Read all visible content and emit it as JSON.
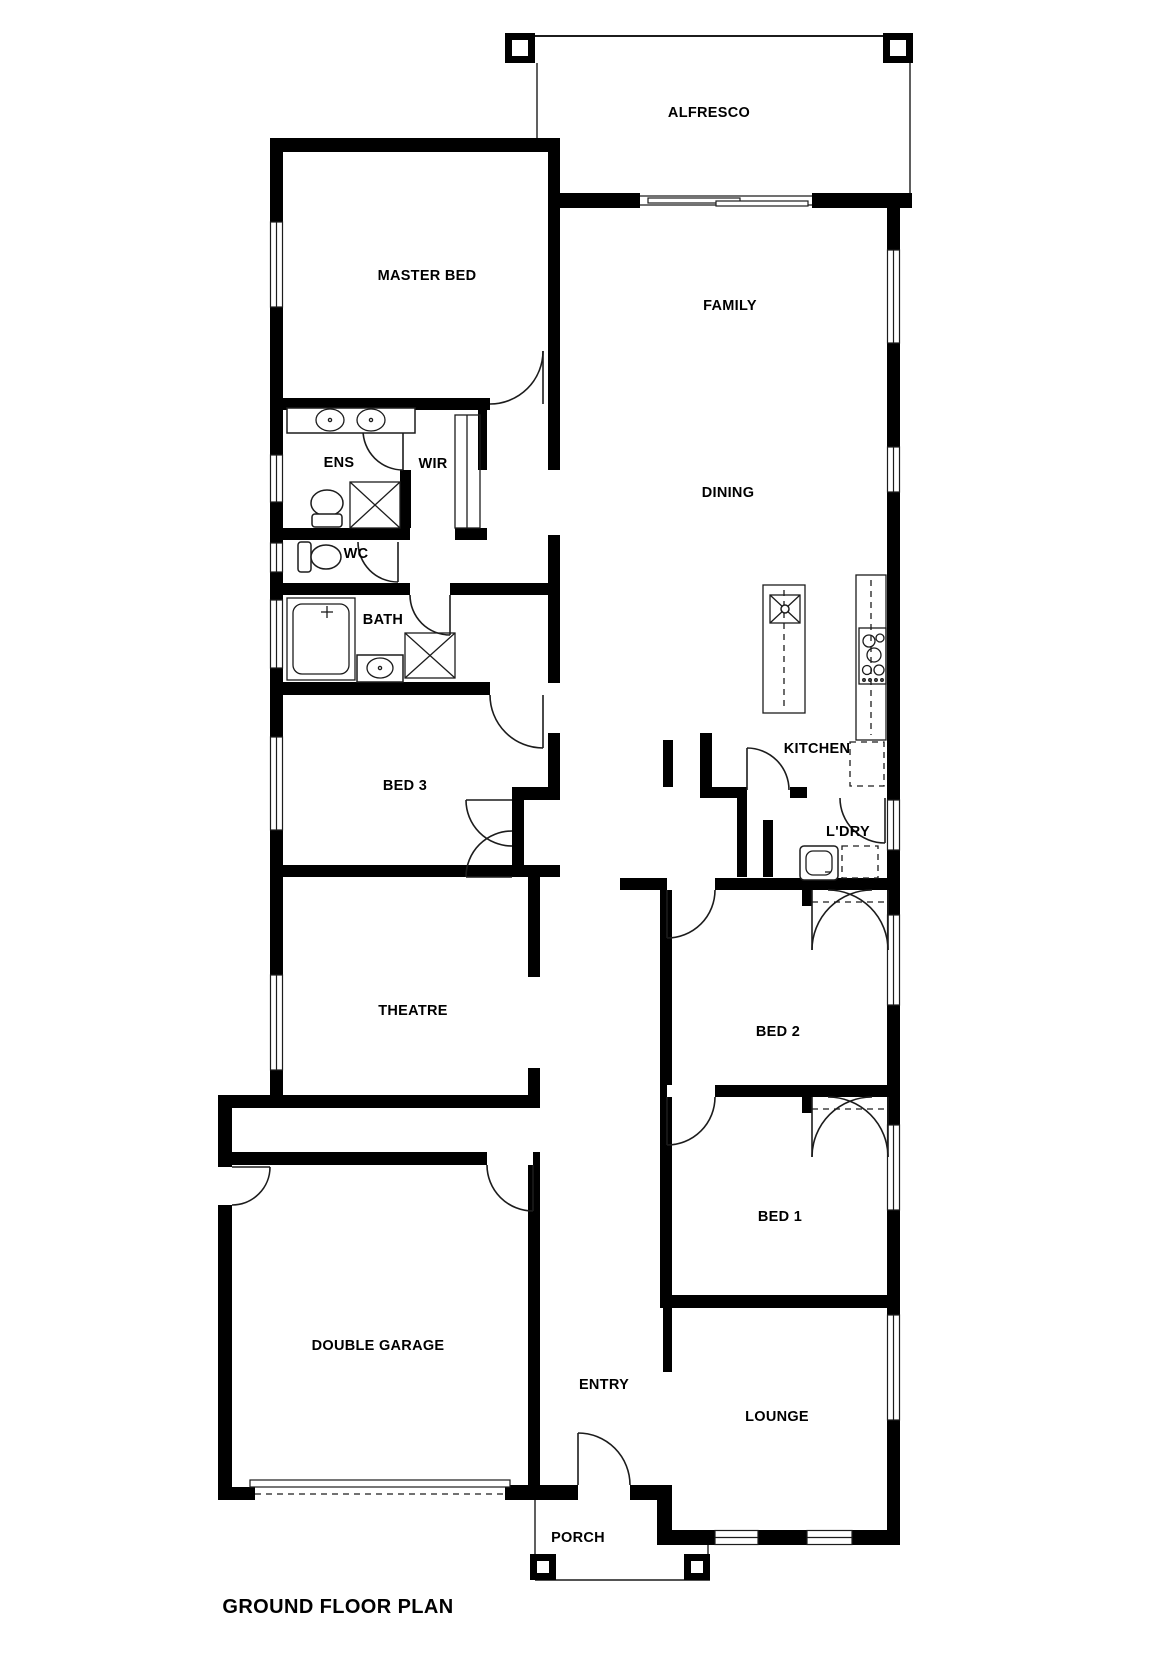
{
  "title": "GROUND FLOOR PLAN",
  "rooms": {
    "alfresco": {
      "label": "ALFRESCO"
    },
    "master_bed": {
      "label": "MASTER BED"
    },
    "family": {
      "label": "FAMILY"
    },
    "ens": {
      "label": "ENS"
    },
    "wir": {
      "label": "WIR"
    },
    "dining": {
      "label": "DINING"
    },
    "wc": {
      "label": "WC"
    },
    "bath": {
      "label": "BATH"
    },
    "bed3": {
      "label": "BED 3"
    },
    "kitchen": {
      "label": "KITCHEN"
    },
    "ldry": {
      "label": "L'DRY"
    },
    "bed2": {
      "label": "BED 2"
    },
    "theatre": {
      "label": "THEATRE"
    },
    "bed1": {
      "label": "BED 1"
    },
    "garage": {
      "label": "DOUBLE GARAGE"
    },
    "entry": {
      "label": "ENTRY"
    },
    "lounge": {
      "label": "LOUNGE"
    },
    "porch": {
      "label": "PORCH"
    }
  },
  "colors": {
    "wall": "#000000",
    "line": "#1c1c1c",
    "background": "#ffffff"
  }
}
